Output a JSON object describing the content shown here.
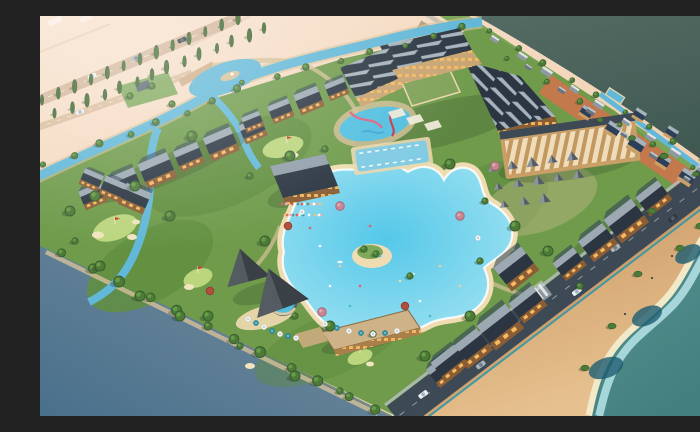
{
  "meta": {
    "title": "Resort Masterplan 3D Aerial Render",
    "description": "Photorealistic isometric 3D rendering of a lakeside golf and waterpark resort: timber lodges with dark gabled roofs, a free-form swimming lagoon with a palm island, golf greens with red flags, winding canals, a sawtooth-roof hotel complex, a striped pergola market, cabana tents, a tree-lined desert highway on peach land, dark lake water, and a coastal road along a sandy beach with turquoise sea."
  },
  "palette": {
    "peach1": "#f8e3cf",
    "peach2": "#eec6a3",
    "table1": "#aeb2b4",
    "table2": "#49708c",
    "lake1": "#546b63",
    "lake2": "#3f5852",
    "sea1": "#5a9792",
    "sea2": "#437f7f",
    "shallow": "#abdade",
    "foam": "#f2e9c9",
    "deep": "#1d5d72",
    "sand1": "#e6c18f",
    "sand2": "#c08a55",
    "road": "#3d4954",
    "roadline": "#b9c1c6",
    "teal": "#2f93a8",
    "green1": "#6f9b4b",
    "green2": "#5d8a3e",
    "fairway": "#628f40",
    "glight": "#bcd67e",
    "bunker": "#f1e5bf",
    "canal": "#62b8d8",
    "canal2": "#7fcbe4",
    "lag1": "#55c8e9",
    "lag2": "#a5e4f2",
    "lagbeach": "#efdcb2",
    "tdark": "#355e2d",
    "tmid": "#4e7a38",
    "tlight": "#6ba34a",
    "cypg": "#41682e",
    "pinkt": "#c98492",
    "redt": "#b04f3d",
    "roofd": "#2b3642",
    "roofl": "#a6b3bc",
    "roofb": "#2d3f58",
    "wood": "#8a5d34",
    "wood2": "#aa7f4a",
    "woodl": "#c9a168",
    "win": "#f6ba62",
    "hotelw": "#c8a472",
    "cream": "#e9d7ae",
    "pergf": "#c99f67",
    "pergs1": "#eedcba",
    "pergs2": "#c2985f",
    "pergtop": "#3d4955",
    "tent": "#3a4046",
    "tentl": "#878f96",
    "cab": "#8b939b",
    "cabd": "#545c65",
    "path": "#d6c198",
    "terra": "#c3794b",
    "strip": "#7aa557",
    "tanst": "#b2a07d",
    "neroad": "#c8c0b0",
    "housg": "#8e99a3",
    "housd": "#68747f",
    "white": "#f2f6f6",
    "shadow": "#273623",
    "flagred": "#d23c2e"
  },
  "scene": {
    "regions": [
      {
        "name": "backdrop-table",
        "desc": "blue-grey display surface, lower left"
      },
      {
        "name": "desert-land",
        "desc": "peach ground with tree-lined highway, upper left"
      },
      {
        "name": "lake-water",
        "desc": "dark teal lake, upper right"
      },
      {
        "name": "sea-beach",
        "desc": "turquoise sea, sandy beach and coastal road, lower right"
      },
      {
        "name": "resort-grounds",
        "desc": "landscaped resort with golf, lagoon, lodges and canals"
      }
    ],
    "features": {
      "lagoon": {
        "desc": "free-form lagoon pool with sand rim and palm island",
        "swimmers": 14
      },
      "golf": {
        "greens": 6,
        "flags": 5,
        "bunkers": 9
      },
      "lodges": {
        "rows": 6,
        "style": "dark gabled roofs, timber facades, lit windows"
      },
      "hotel": {
        "wings": 3,
        "roof": "sawtooth"
      },
      "pergola_market": {
        "stripe_rows": 15
      },
      "cabanas": {
        "count": 13
      },
      "event_tents": {
        "count": 2
      },
      "canals": {
        "count": 4
      },
      "coastal_road": {
        "cars": 7
      },
      "highway": {
        "tree_rows": 2,
        "cars": 3
      },
      "cottages": {
        "count": 7
      },
      "village_houses": {
        "count": 15
      },
      "umbrellas": {
        "count": 16
      },
      "trees": {
        "approx": 90
      }
    }
  }
}
